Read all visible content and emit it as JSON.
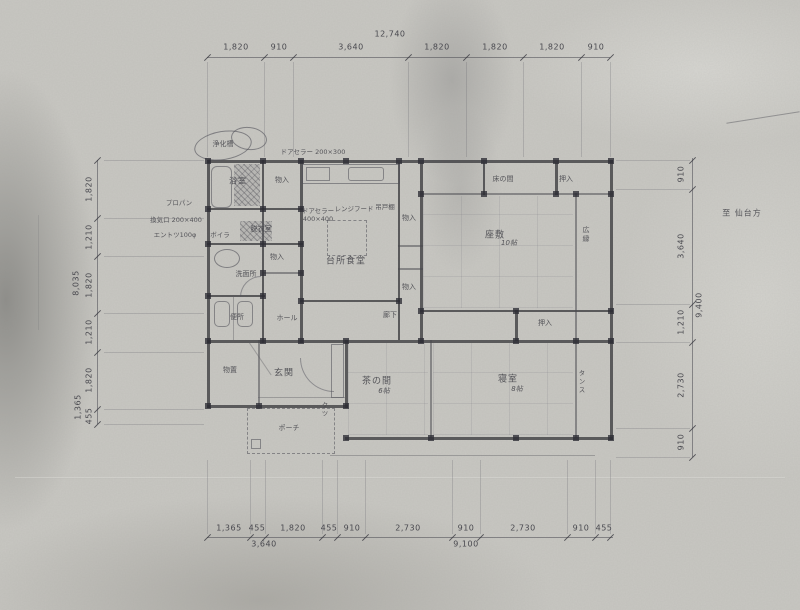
{
  "drawing": {
    "kind": "scanned-house-floor-plan",
    "direction_note": "至 仙台方"
  },
  "dims": {
    "top": {
      "total": "12,740",
      "segments": [
        "1,820",
        "910",
        "3,640",
        "1,820",
        "1,820",
        "1,820",
        "910"
      ]
    },
    "bottom": {
      "segments": [
        "1,365",
        "455",
        "1,820",
        "455",
        "910",
        "2,730",
        "910",
        "2,730",
        "910",
        "455"
      ],
      "subtotal_left": "3,640",
      "subtotal_right": "9,100"
    },
    "left": {
      "total": "8,035",
      "segments": [
        "1,820",
        "1,210",
        "1,820",
        "1,210",
        "1,820",
        "455"
      ],
      "extra": "1,365"
    },
    "right": {
      "total": "9,400",
      "segments": [
        "910",
        "3,640",
        "1,210",
        "2,730",
        "910"
      ]
    }
  },
  "rooms": {
    "bath": "浴室",
    "utility_closet": "物入",
    "dressing": "脱衣室",
    "boiler": "ボイラ",
    "washroom": "洗面所",
    "toilet": "便所",
    "hall_closet": "物入",
    "hall": "ホール",
    "kitchen_dining": "台所食堂",
    "tokonoma": "床の間",
    "oshiire_top": "押入",
    "zashiki": "座敷",
    "zashiki_size": "10帖",
    "hiroen": "広縁",
    "oshiire_mid": "押入",
    "corridor": "廊下",
    "storage": "物置",
    "entrance": "玄関",
    "porch": "ポーチ",
    "chanoma": "茶の間",
    "chanoma_size": "6帖",
    "bedroom": "寝室",
    "bedroom_size": "8帖",
    "kitchen_closet_upper": "物入",
    "kitchen_closet_lower": "物入",
    "shoes": "クツ",
    "tansu": "タンス"
  },
  "annotations": {
    "septic_tank": "浄化槽",
    "door_note_top": "ドアセラー 200×300",
    "door_note_kitchen": "ドアセラー 400×400",
    "range_hood": "レンジフード",
    "hanging_cupboard": "吊戸棚",
    "propane": "プロパン",
    "vent": "換気口 200×400",
    "chimney": "エントツ100φ",
    "direction": "至 仙台方"
  }
}
